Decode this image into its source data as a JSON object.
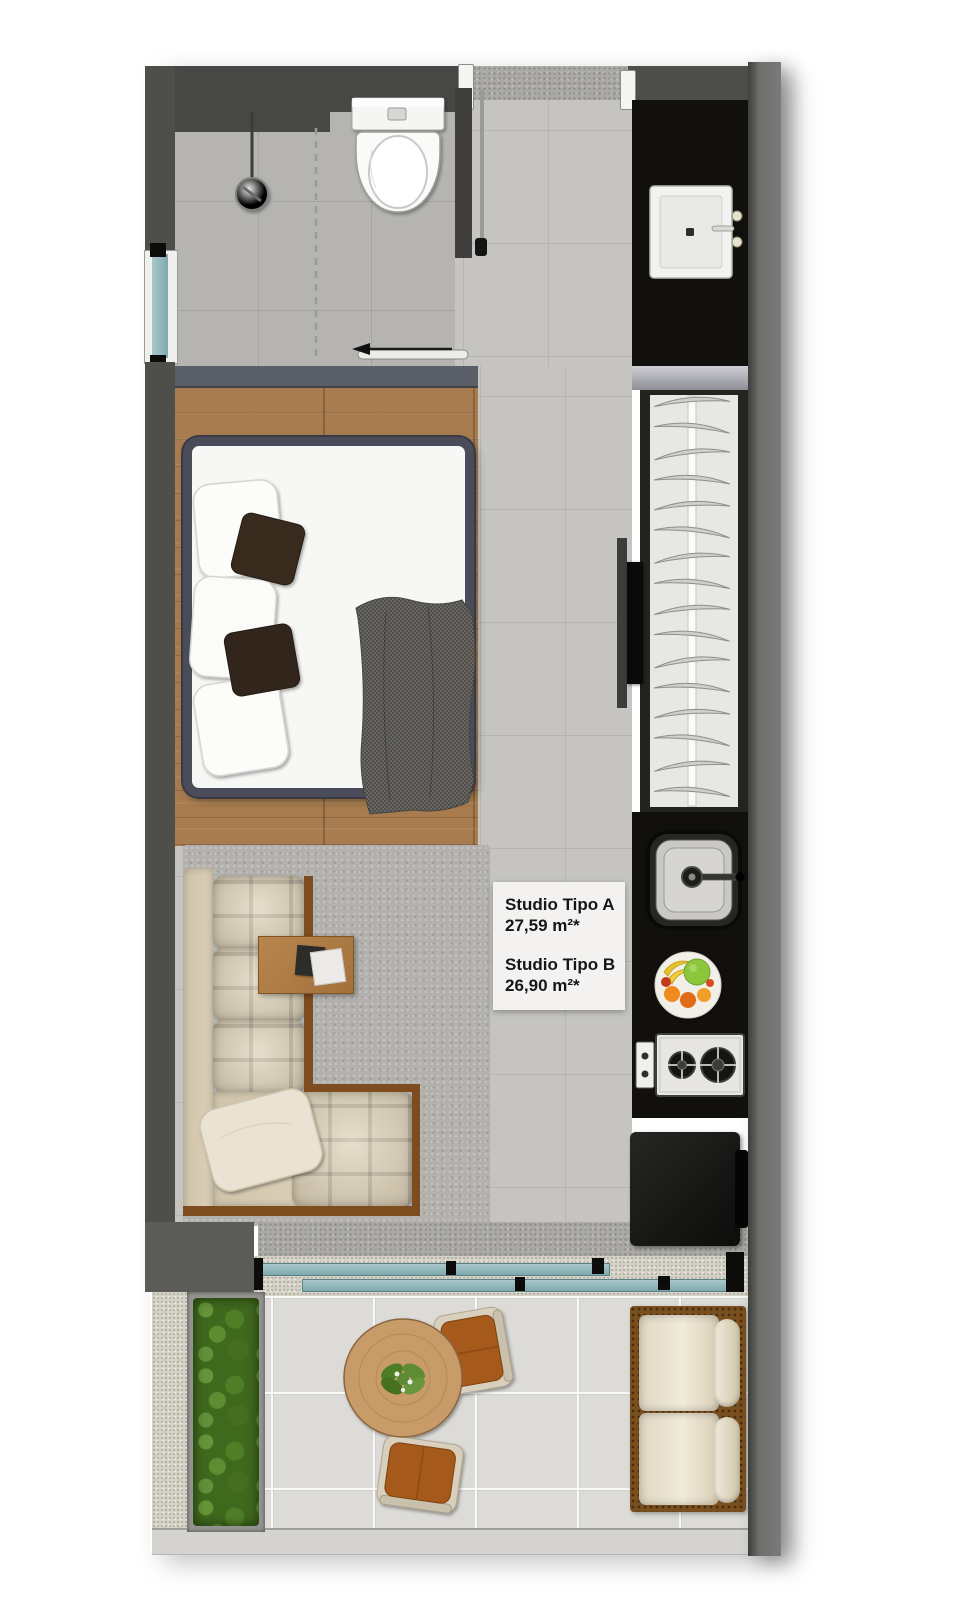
{
  "plan": {
    "title": "studio-apartment-floor-plan",
    "units": [
      {
        "name": "Studio Tipo A",
        "area": "27,59 m²*"
      },
      {
        "name": "Studio Tipo B",
        "area": "26,90 m²*"
      }
    ]
  },
  "furniture_icons": [
    "toilet-icon",
    "shower-drain-icon",
    "bathroom-sink-icon",
    "entry-door-icon",
    "sliding-door-icon",
    "double-bed-icon",
    "pillow-icon",
    "blanket-icon",
    "wall-tv-icon",
    "wardrobe-hangers-icon",
    "kitchen-sink-icon",
    "fruit-bowl-icon",
    "cooktop-icon",
    "refrigerator-icon",
    "l-shaped-sofa-icon",
    "side-table-icon",
    "area-rug-icon",
    "planter-icon",
    "round-table-icon",
    "chair-icon",
    "bench-icon",
    "window-icon"
  ],
  "colors": {
    "wall": "#4e4e4b",
    "counter": "#12100d",
    "wood": "#a87c4e",
    "trim": "#7d4c1f",
    "sofa": "#dcd0b6",
    "rug": "#b3b1ad",
    "granite": "#aba9a4",
    "speckle": "#d6d3c6",
    "balcony_tile": "#dcdbd7",
    "bed_frame": "#4b4c59",
    "glass": "#8fb8bc",
    "wicker": "#7a4f1e",
    "label_bg": "#f3f2f0",
    "ink": "#161616",
    "plant_green": "#4e7a28",
    "chair_cushion": "#a55a1d",
    "table_wood": "#c89c68"
  }
}
